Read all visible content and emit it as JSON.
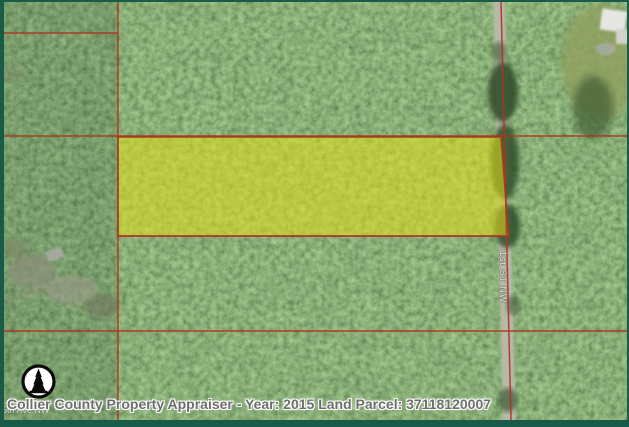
{
  "map": {
    "title": "Collier County Property Appraiser parcel map",
    "caption": "Collier County Property Appraiser - Year: 2015 Land Parcel: 37118120007",
    "year": "2015",
    "parcel_id": "37118120007",
    "road_label": "1st ST NW",
    "faint_street_label": "5th Ave NW",
    "north_arrow": "north-compass",
    "colors": {
      "parcel_highlight": "#e2de18",
      "parcel_boundary_red": "#b2331e",
      "frame_green": "#1a5a49",
      "road_gray": "#b6b8a8",
      "caption_text": "#6e6e6e",
      "forest_green": "#3a5c30"
    }
  }
}
